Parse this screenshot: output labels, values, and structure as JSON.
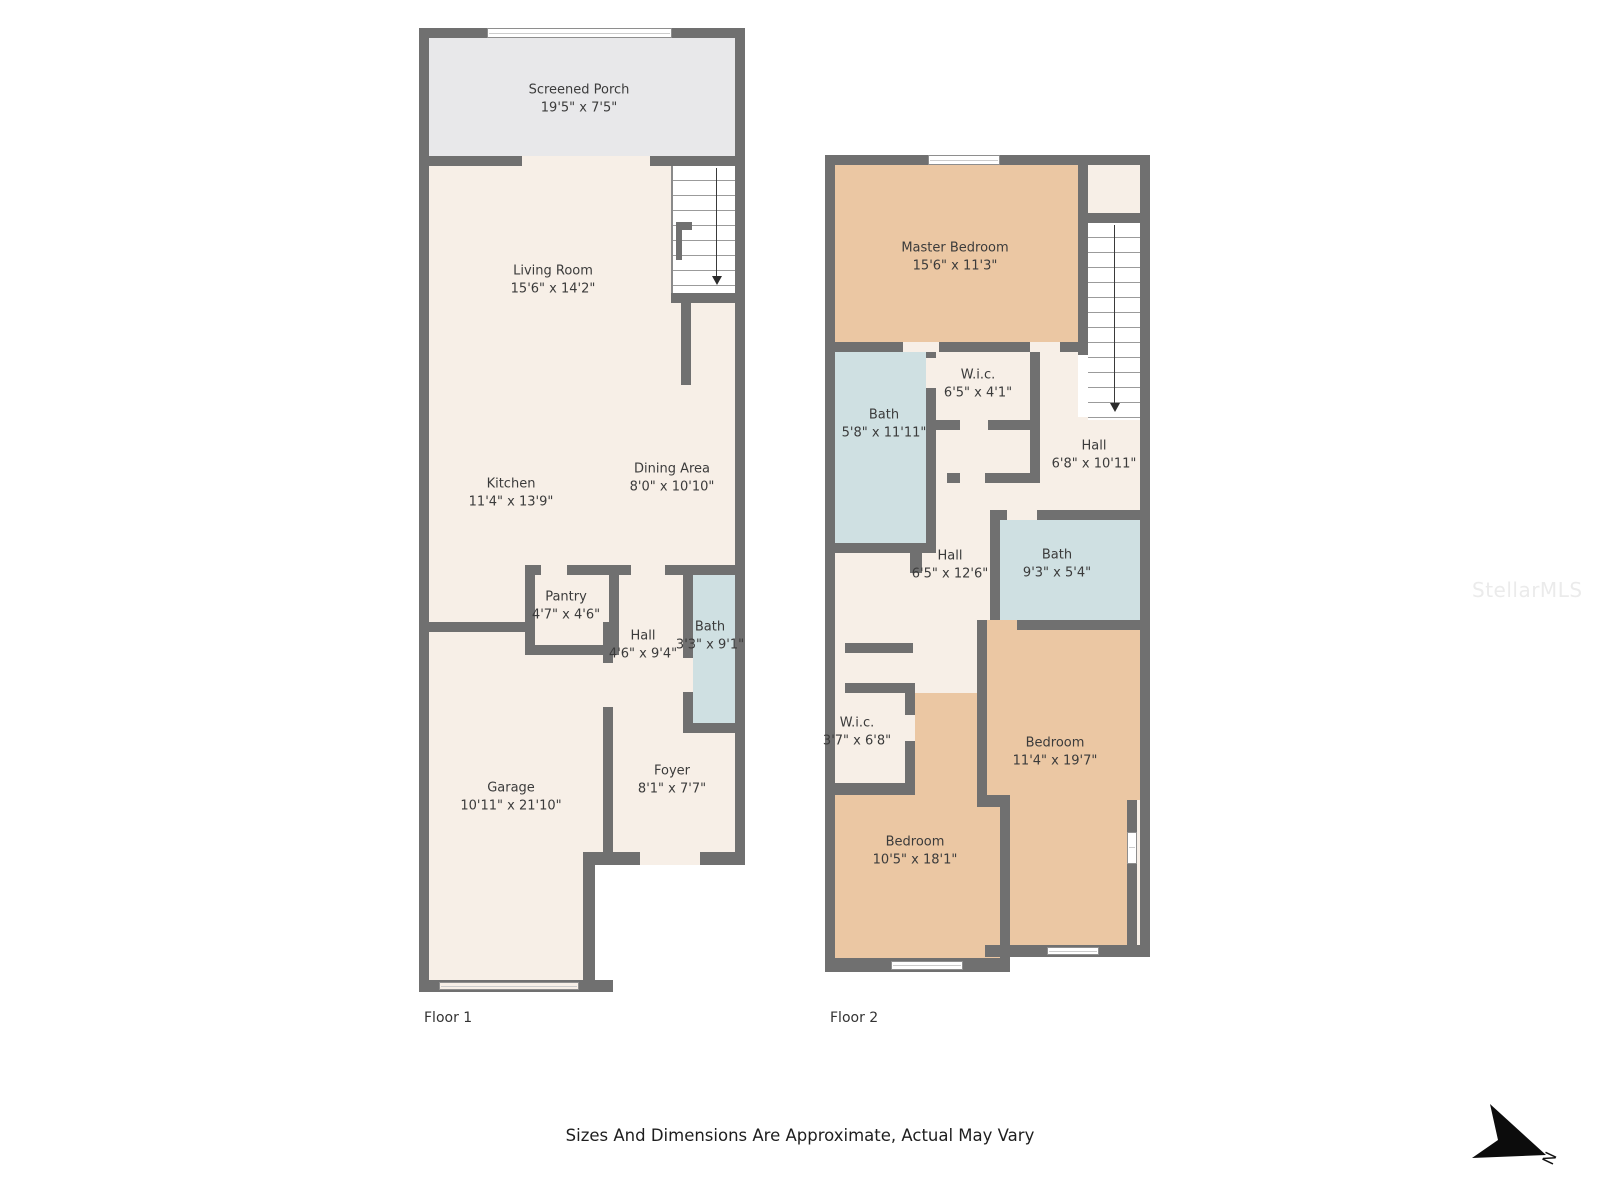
{
  "page": {
    "disclaimer": "Sizes And Dimensions Are Approximate, Actual May Vary",
    "watermark": "StellarMLS",
    "north_label": "N"
  },
  "colors": {
    "wall": "#707070",
    "floor": "#f7efe7",
    "porch": "#e8e8ea",
    "blue": "#cfe0e2",
    "tan": "#ebc7a3"
  },
  "floors": [
    {
      "label": "Floor 1",
      "rooms": [
        {
          "name": "Screened Porch",
          "dims": "19'5\" x 7'5\""
        },
        {
          "name": "Living Room",
          "dims": "15'6\" x 14'2\""
        },
        {
          "name": "Kitchen",
          "dims": "11'4\" x 13'9\""
        },
        {
          "name": "Dining Area",
          "dims": "8'0\" x 10'10\""
        },
        {
          "name": "Pantry",
          "dims": "4'7\" x 4'6\""
        },
        {
          "name": "Hall",
          "dims": "4'6\" x 9'4\""
        },
        {
          "name": "Bath",
          "dims": "3'3\" x 9'1\""
        },
        {
          "name": "Garage",
          "dims": "10'11\" x 21'10\""
        },
        {
          "name": "Foyer",
          "dims": "8'1\" x 7'7\""
        }
      ]
    },
    {
      "label": "Floor 2",
      "rooms": [
        {
          "name": "Master Bedroom",
          "dims": "15'6\" x 11'3\""
        },
        {
          "name": "Bath",
          "dims": "5'8\" x 11'11\""
        },
        {
          "name": "W.i.c.",
          "dims": "6'5\" x 4'1\""
        },
        {
          "name": "Hall",
          "dims": "6'8\" x 10'11\""
        },
        {
          "name": "Hall",
          "dims": "6'5\" x 12'6\""
        },
        {
          "name": "Bath",
          "dims": "9'3\" x 5'4\""
        },
        {
          "name": "W.i.c.",
          "dims": "3'7\" x 6'8\""
        },
        {
          "name": "Bedroom",
          "dims": "11'4\" x 19'7\""
        },
        {
          "name": "Bedroom",
          "dims": "10'5\" x 18'1\""
        }
      ]
    }
  ]
}
